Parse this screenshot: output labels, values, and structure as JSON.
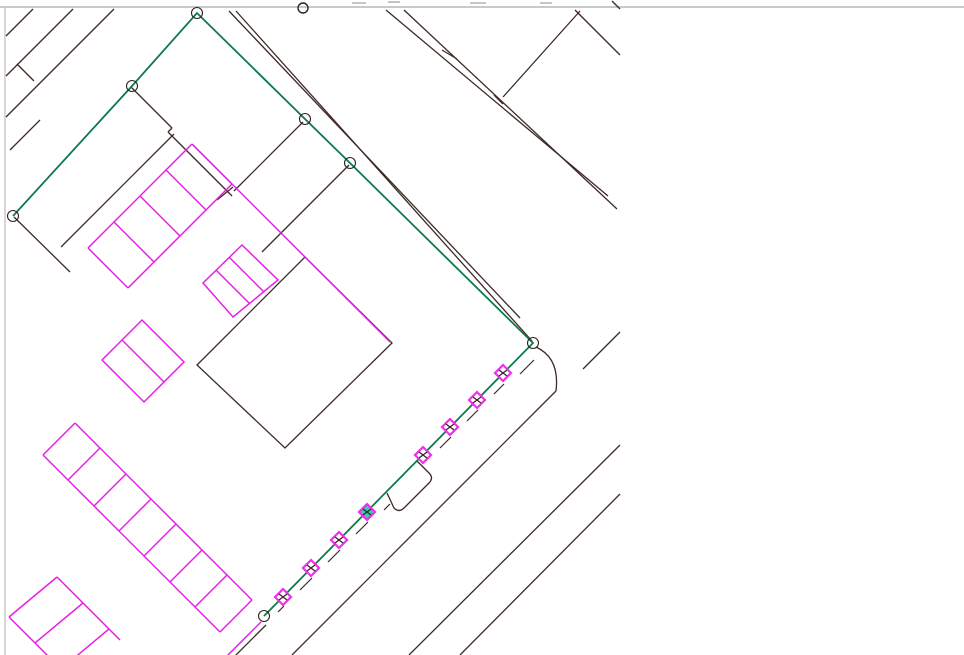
{
  "app": {
    "kind": "cad-map-viewport",
    "description": "site plan drawing canvas with survey boundary, roads, parking stalls and point markers"
  },
  "canvas": {
    "width": 964,
    "height": 655,
    "background": "#ffffff",
    "border_color": "#c9c9c9",
    "top_border_y": 7,
    "left_border_x": 5
  },
  "colors": {
    "parcel_lines": "#3e2a26",
    "parking_lines": "#e621e6",
    "boundary": "#0d7a4c",
    "marker_outline": "#ef2fef",
    "marker_fill": "#ffffff",
    "marker_selected_fill": "#3cc9b3",
    "marker_hatch": "#3a2424",
    "vertex_ring": "#2b2222",
    "decor_dash": "#c5c5c5"
  },
  "layers": {
    "roads": {
      "width": 1.3,
      "segments": [
        [
          6,
          36,
          33,
          9
        ],
        [
          6,
          76,
          73,
          9
        ],
        [
          17,
          64,
          34,
          81
        ],
        [
          6,
          117,
          114,
          9
        ],
        [
          10,
          150,
          40,
          120
        ],
        [
          229,
          11,
          520,
          318
        ],
        [
          236,
          11,
          532,
          341
        ],
        [
          386,
          10,
          608,
          196
        ],
        [
          404,
          10,
          617,
          209
        ],
        [
          442,
          50,
          457,
          59
        ],
        [
          494,
          95,
          503,
          104
        ],
        [
          503,
          97,
          580,
          11
        ],
        [
          575,
          10,
          620,
          55
        ],
        [
          612,
          1,
          620,
          9
        ],
        [
          583,
          369,
          620,
          332
        ],
        [
          556,
          391,
          292,
          655
        ],
        [
          620,
          445,
          409,
          655
        ],
        [
          620,
          494,
          460,
          655
        ],
        [
          14,
          217,
          70,
          272
        ],
        [
          131,
          87,
          172,
          128
        ],
        [
          172,
          128,
          168,
          132
        ],
        [
          168,
          132,
          173,
          137
        ],
        [
          173,
          137,
          232,
          196
        ],
        [
          217,
          200,
          233,
          187
        ],
        [
          174,
          134,
          61,
          247
        ],
        [
          303,
          122,
          234,
          191
        ],
        [
          349,
          165,
          262,
          252
        ],
        [
          266,
          625,
          230,
          661
        ]
      ]
    },
    "curb": {
      "width": 1.2,
      "segments": [
        [
          534,
          360,
          520,
          374
        ],
        [
          504,
          384,
          494,
          394
        ],
        [
          478,
          410,
          467,
          421
        ],
        [
          451,
          437,
          440,
          448
        ],
        [
          390,
          504,
          384,
          510
        ],
        [
          368,
          522,
          356,
          534
        ],
        [
          340,
          550,
          328,
          562
        ],
        [
          312,
          578,
          300,
          590
        ],
        [
          284,
          606,
          278,
          612
        ]
      ]
    },
    "buildings": {
      "width": 1.3,
      "polygons": [
        [
          [
            197,
            365
          ],
          [
            305,
            257
          ],
          [
            392,
            343
          ],
          [
            285,
            448
          ]
        ]
      ],
      "paths": [
        "M 417 461 L 429 473 Q 434 478 429 483 L 404 508 Q 399 513 394 508 L 387 493"
      ]
    },
    "roadside_arc": {
      "path": "M 536 347 Q 560 358 556 391",
      "width": 1.3
    },
    "parking": {
      "width": 1.5,
      "segments": [
        [
          192,
          144,
          88,
          248
        ],
        [
          232,
          184,
          128,
          288
        ],
        [
          192,
          144,
          232,
          184
        ],
        [
          166,
          170,
          206,
          210
        ],
        [
          140,
          196,
          180,
          236
        ],
        [
          114,
          222,
          154,
          262
        ],
        [
          88,
          248,
          128,
          288
        ],
        [
          193,
          145,
          390,
          342
        ],
        [
          75,
          423,
          252,
          600
        ],
        [
          43,
          455,
          220,
          632
        ],
        [
          75,
          423,
          43,
          455
        ],
        [
          100,
          448,
          68,
          480
        ],
        [
          126,
          474,
          94,
          506
        ],
        [
          151,
          499,
          119,
          531
        ],
        [
          176,
          524,
          144,
          556
        ],
        [
          202,
          550,
          170,
          582
        ],
        [
          227,
          575,
          195,
          607
        ],
        [
          252,
          600,
          220,
          632
        ],
        [
          57,
          577,
          120,
          640
        ],
        [
          9,
          617,
          70,
          678
        ],
        [
          57,
          577,
          9,
          617
        ],
        [
          83,
          603,
          35,
          643
        ],
        [
          109,
          629,
          61,
          669
        ],
        [
          261,
          622,
          225,
          658
        ],
        [
          216,
          270,
          250,
          304
        ],
        [
          229,
          257,
          264,
          292
        ],
        [
          122,
          340,
          164,
          382
        ]
      ],
      "polygons": [
        [
          [
            203,
            283
          ],
          [
            242,
            245
          ],
          [
            278,
            280
          ],
          [
            233,
            317
          ]
        ],
        [
          [
            102,
            360
          ],
          [
            142,
            320
          ],
          [
            184,
            362
          ],
          [
            144,
            402
          ]
        ]
      ]
    },
    "boundary": {
      "width": 1.8,
      "polyline": [
        [
          13,
          216
        ],
        [
          132,
          86
        ],
        [
          197,
          13
        ],
        [
          305,
          119
        ],
        [
          350,
          163
        ],
        [
          533,
          343
        ],
        [
          264,
          616
        ]
      ],
      "vertices": [
        [
          13,
          216
        ],
        [
          132,
          86
        ],
        [
          197,
          13
        ],
        [
          305,
          119
        ],
        [
          350,
          163
        ],
        [
          533,
          343
        ],
        [
          264,
          616
        ]
      ],
      "vertex_radius": 5.5
    },
    "markers": {
      "half_size": 8,
      "points": [
        {
          "x": 503,
          "y": 373,
          "selected": false
        },
        {
          "x": 477,
          "y": 400,
          "selected": false
        },
        {
          "x": 450,
          "y": 427,
          "selected": false
        },
        {
          "x": 423,
          "y": 455,
          "selected": false
        },
        {
          "x": 367,
          "y": 512,
          "selected": true
        },
        {
          "x": 339,
          "y": 540,
          "selected": false
        },
        {
          "x": 311,
          "y": 568,
          "selected": false
        },
        {
          "x": 283,
          "y": 597,
          "selected": false
        }
      ]
    },
    "decor": {
      "top_circle": {
        "x": 303,
        "y": 8,
        "r": 5
      },
      "dashes": [
        [
          352,
          3,
          366,
          3
        ],
        [
          388,
          2,
          400,
          2
        ],
        [
          470,
          3,
          486,
          3
        ],
        [
          540,
          3,
          552,
          3
        ]
      ]
    }
  }
}
